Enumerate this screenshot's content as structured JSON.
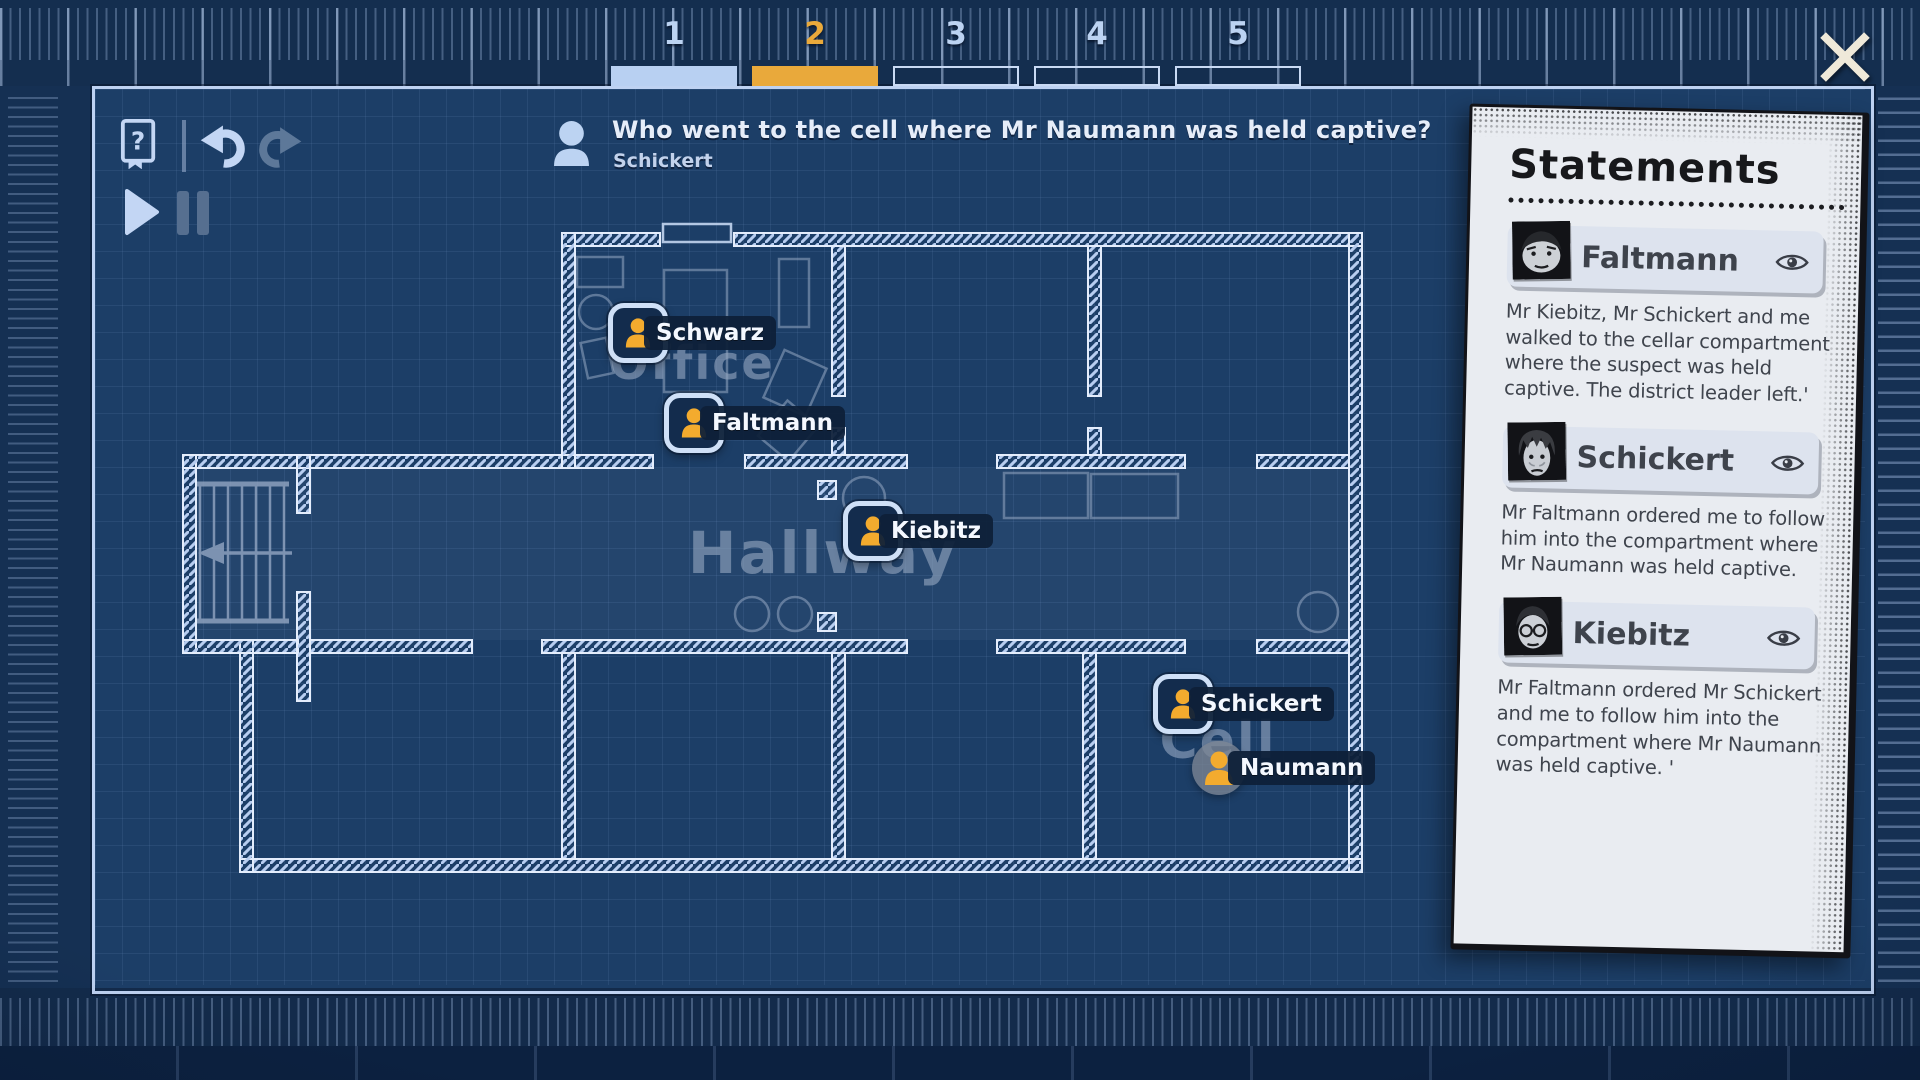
{
  "progress": {
    "steps": [
      {
        "label": "1",
        "state": "done"
      },
      {
        "label": "2",
        "state": "current"
      },
      {
        "label": "3",
        "state": "todo"
      },
      {
        "label": "4",
        "state": "todo"
      },
      {
        "label": "5",
        "state": "todo"
      }
    ]
  },
  "question": {
    "title": "Who went to the cell where Mr Naumann was held captive?",
    "answer": "Schickert"
  },
  "floorplan": {
    "rooms": [
      {
        "name": "Office"
      },
      {
        "name": "Hallway"
      },
      {
        "name": "Cell"
      }
    ],
    "characters": [
      {
        "name": "Schwarz",
        "role": "suspect"
      },
      {
        "name": "Faltmann",
        "role": "suspect"
      },
      {
        "name": "Kiebitz",
        "role": "suspect"
      },
      {
        "name": "Schickert",
        "role": "suspect"
      },
      {
        "name": "Naumann",
        "role": "victim"
      }
    ]
  },
  "statements": {
    "title": "Statements",
    "items": [
      {
        "name": "Faltmann",
        "text": "Mr Kiebitz, Mr Schickert and me walked to the cellar compartment where the suspect was held captive. The district leader left.'"
      },
      {
        "name": "Schickert",
        "text": "Mr Faltmann ordered me to follow him into the compartment where Mr Naumann was held captive."
      },
      {
        "name": "Kiebitz",
        "text": "Mr Faltmann ordered Mr Schickert and me to follow him into the compartment where Mr Naumann was held captive. '"
      }
    ]
  },
  "colors": {
    "background": "#1c3e67",
    "wall_line": "#bcd2f2",
    "accent_orange": "#e9a93b",
    "accent_blue": "#b8d0f2",
    "paper": "#e9ecf1",
    "token_orange": "#f3ab2e"
  }
}
